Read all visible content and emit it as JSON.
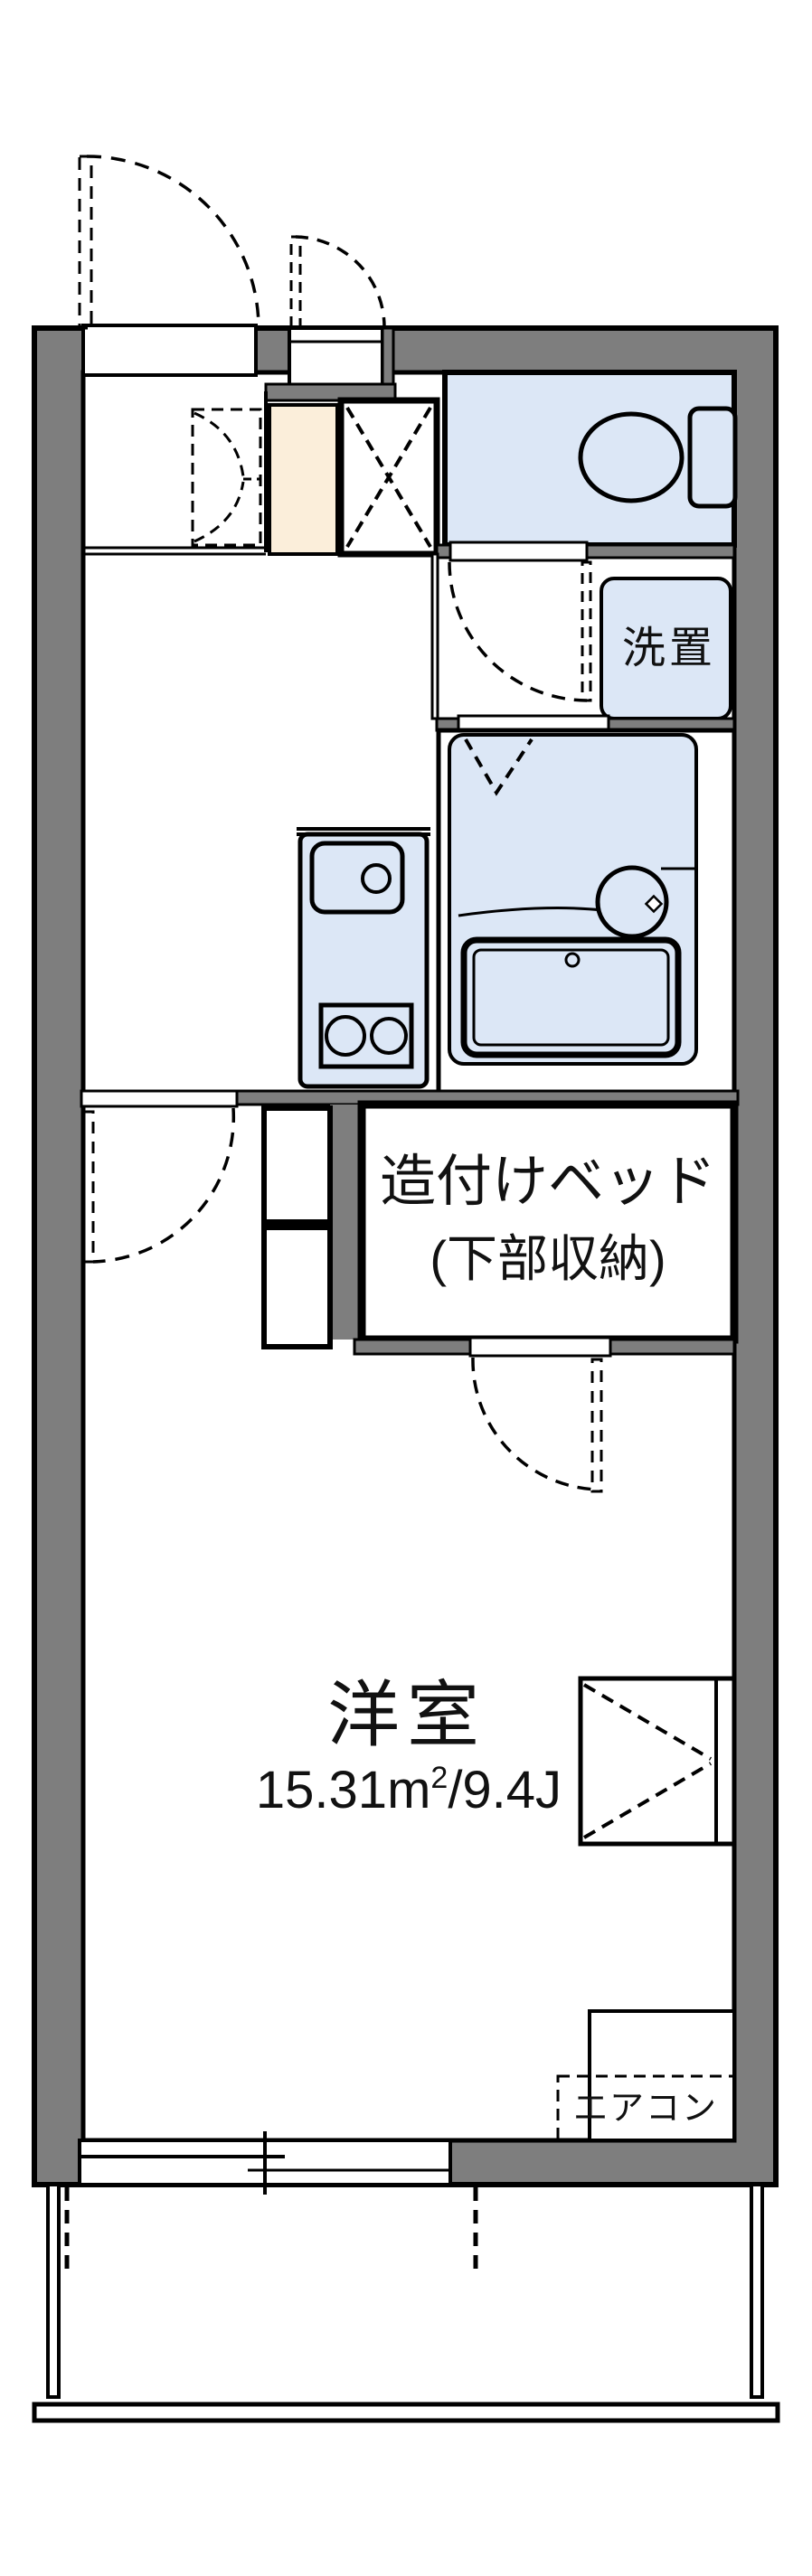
{
  "plan": {
    "labels": {
      "room": "洋室",
      "area_left": "15.31m",
      "area_sup": "2",
      "area_right": "/9.4J",
      "bed_line1": "造付けベッド",
      "bed_line2": "(下部収納)",
      "washer": "洗置",
      "aircon": "エアコン"
    },
    "colors": {
      "wall": "#7e7e7e",
      "fixture": "#dce7f6",
      "beige": "#fbeeda",
      "line": "#000000",
      "background": "#ffffff"
    }
  }
}
